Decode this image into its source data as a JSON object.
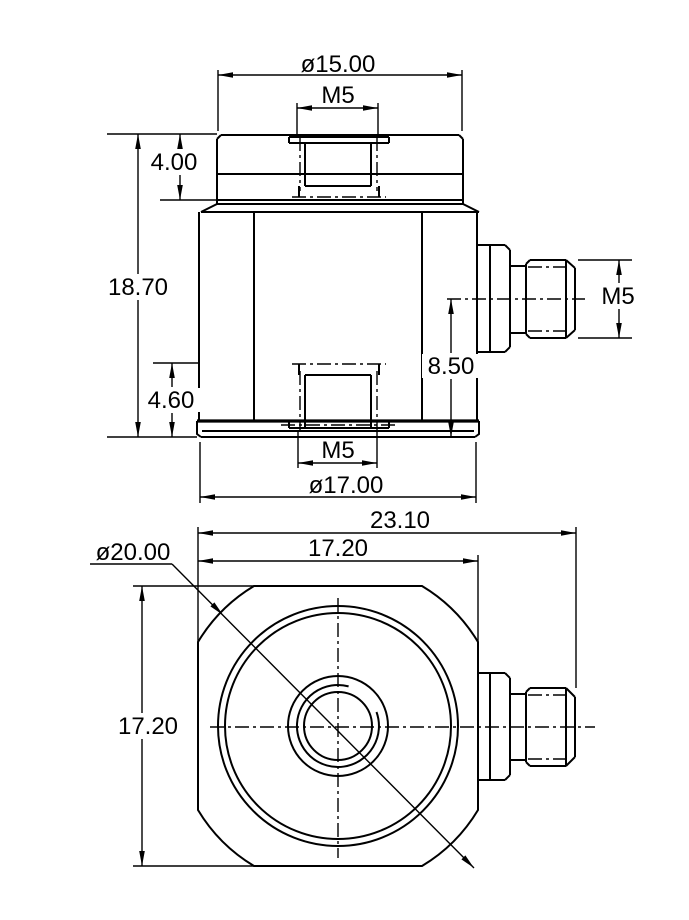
{
  "drawing": {
    "type": "technical-dimension-drawing",
    "colors": {
      "line": "#000000",
      "background": "#ffffff"
    },
    "front_view": {
      "cap_diameter": "ø15.00",
      "cap_thread": "M5",
      "cap_height": "4.00",
      "total_height": "18.70",
      "base_height": "4.60",
      "base_thread": "M5",
      "base_diameter": "ø17.00",
      "connector_thread": "M5",
      "connector_center_height": "8.50"
    },
    "plan_view": {
      "overall_width": "23.10",
      "across_flats_width": "17.20",
      "across_flats_height": "17.20",
      "body_diameter": "ø20.00"
    }
  }
}
